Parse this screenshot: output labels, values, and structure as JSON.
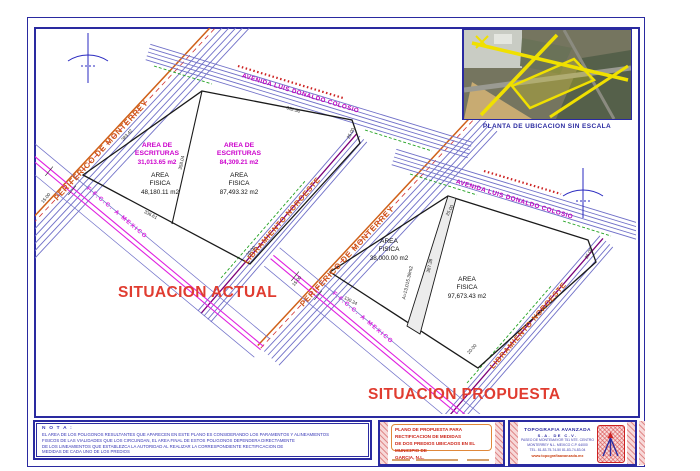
{
  "titles": {
    "actual": "SITUACION ACTUAL",
    "propuesta": "SITUACION PROPUESTA"
  },
  "roads": {
    "periferico": "PERIFERICO DE MONTERREY",
    "avenida": "AVENIDA LUIS DONALDO COLOSIO",
    "libramiento": "LIBRAMIENTO NOROESTE",
    "ferrocarril": "F.F.C.C. A MEXICO"
  },
  "labels": {
    "area_de": "AREA DE",
    "escrituras": "ESCRITURAS",
    "area": "AREA",
    "fisica": "FISICA"
  },
  "actual": {
    "escrituras1": "31,013.65 m2",
    "fisica1": "48,180.11 m2",
    "escrituras2": "84,309.21 m2",
    "fisica2": "87,493.32 m2",
    "dims": {
      "top": "352.90",
      "right": "25.00",
      "left": "383.42",
      "divider": "358.04",
      "bottom": "336.61",
      "rail": "15.00",
      "corner": "20.00"
    }
  },
  "propuesta": {
    "fisica1": "38,000.00 m2",
    "fisica2": "97,673.43 m2",
    "sliver": "A=13,015.39m2",
    "dims": {
      "top": "25.00",
      "right": "25.00",
      "divider": "387.38",
      "bottom": "130.34",
      "rail": "15.00",
      "corner": "20.00"
    }
  },
  "inset": {
    "caption": "PLANTA DE UBICACION SIN ESCALA"
  },
  "nota": {
    "heading": "N O T A :",
    "lines": [
      "EL AREA DE LOS POLIGONOS RESULTANTES QUE APARECEN EN ESTE PLANO ES CONSIDERANDO LOS PARAMENTOS Y ALINEAMIENTOS",
      "FISICOS DE LAS VIALIDADES QUE LOS CIRCUNDAN, EL AREA FINAL DE ESTOS POLIGONOS DEPENDERA DIRECTAMENTE",
      "DE LOS LINEAMIENTOS QUE ESTABLEZCA LA AUTORIDAD AL REALIZAR LA CORRESPONDIENTE RECTIFICACION DE",
      "MEDIDAS DE CADA UNO DE LOS PREDIOS"
    ]
  },
  "titleblock": {
    "left": {
      "line1": "PLANO DE PROPUESTA PARA RECTIFICACION DE MEDIDAS",
      "line2": "DE DOS PREDIOS UBICADOS EN EL MUNICIPIO DE",
      "line3": "GARCIA, N.L."
    },
    "right": {
      "company": "TOPOGRAFIA AVANZADA",
      "company2": "S.A. DE C.V.",
      "addr1": "PASEO DE MONTEMAYOR 751 NTE. CENTRO",
      "addr2": "MONTERREY N.L. MEXICO  C.P. 64000",
      "tel": "TEL. 81-83-75-74-50   81-83-74-83-04",
      "web": "www.topografiaavanzada.mx"
    }
  },
  "colors": {
    "frame_blue": "#2a2aa0",
    "road_label_orange": "#cf5518",
    "magenta": "#cc00cc",
    "railway_magenta": "#e020e0",
    "situacion_red": "#e03c30",
    "green": "#21a121",
    "purple": "#7a007a",
    "road_blue": "#7070c8"
  }
}
